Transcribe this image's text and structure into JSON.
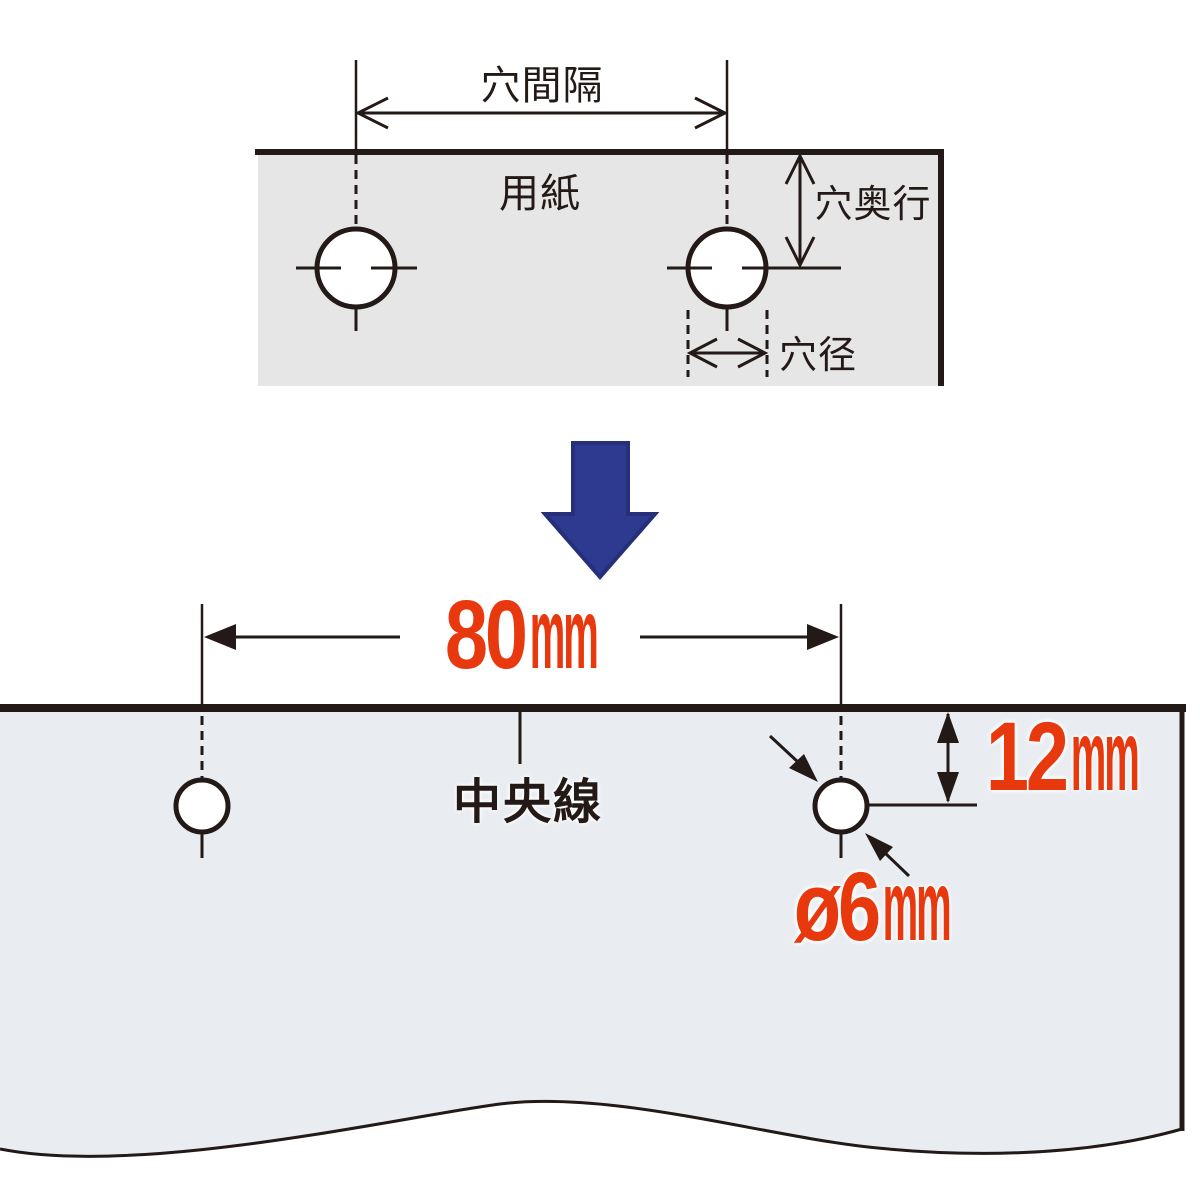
{
  "figure": {
    "description_labels": {
      "top_diagram": {
        "paper_label": "用紙",
        "hole_spacing_label": "穴間隔",
        "hole_depth_label": "穴奥行",
        "hole_diameter_label": "穴径"
      },
      "bottom_diagram": {
        "center_line_label": "中央線",
        "hole_spacing": {
          "value": "80",
          "unit": "mm"
        },
        "hole_depth": {
          "value": "12",
          "unit": "mm"
        },
        "hole_diameter": {
          "value": "ø6",
          "unit": "mm"
        }
      }
    },
    "colors": {
      "dimension_red": "#e8380d",
      "transform_arrow_blue": "#2e3a8f",
      "transform_arrow_border": "#252f7a",
      "line_black": "#231916",
      "paper_top_fill": "#e6e6e6",
      "paper_bottom_fill": "#e9edf1"
    }
  }
}
